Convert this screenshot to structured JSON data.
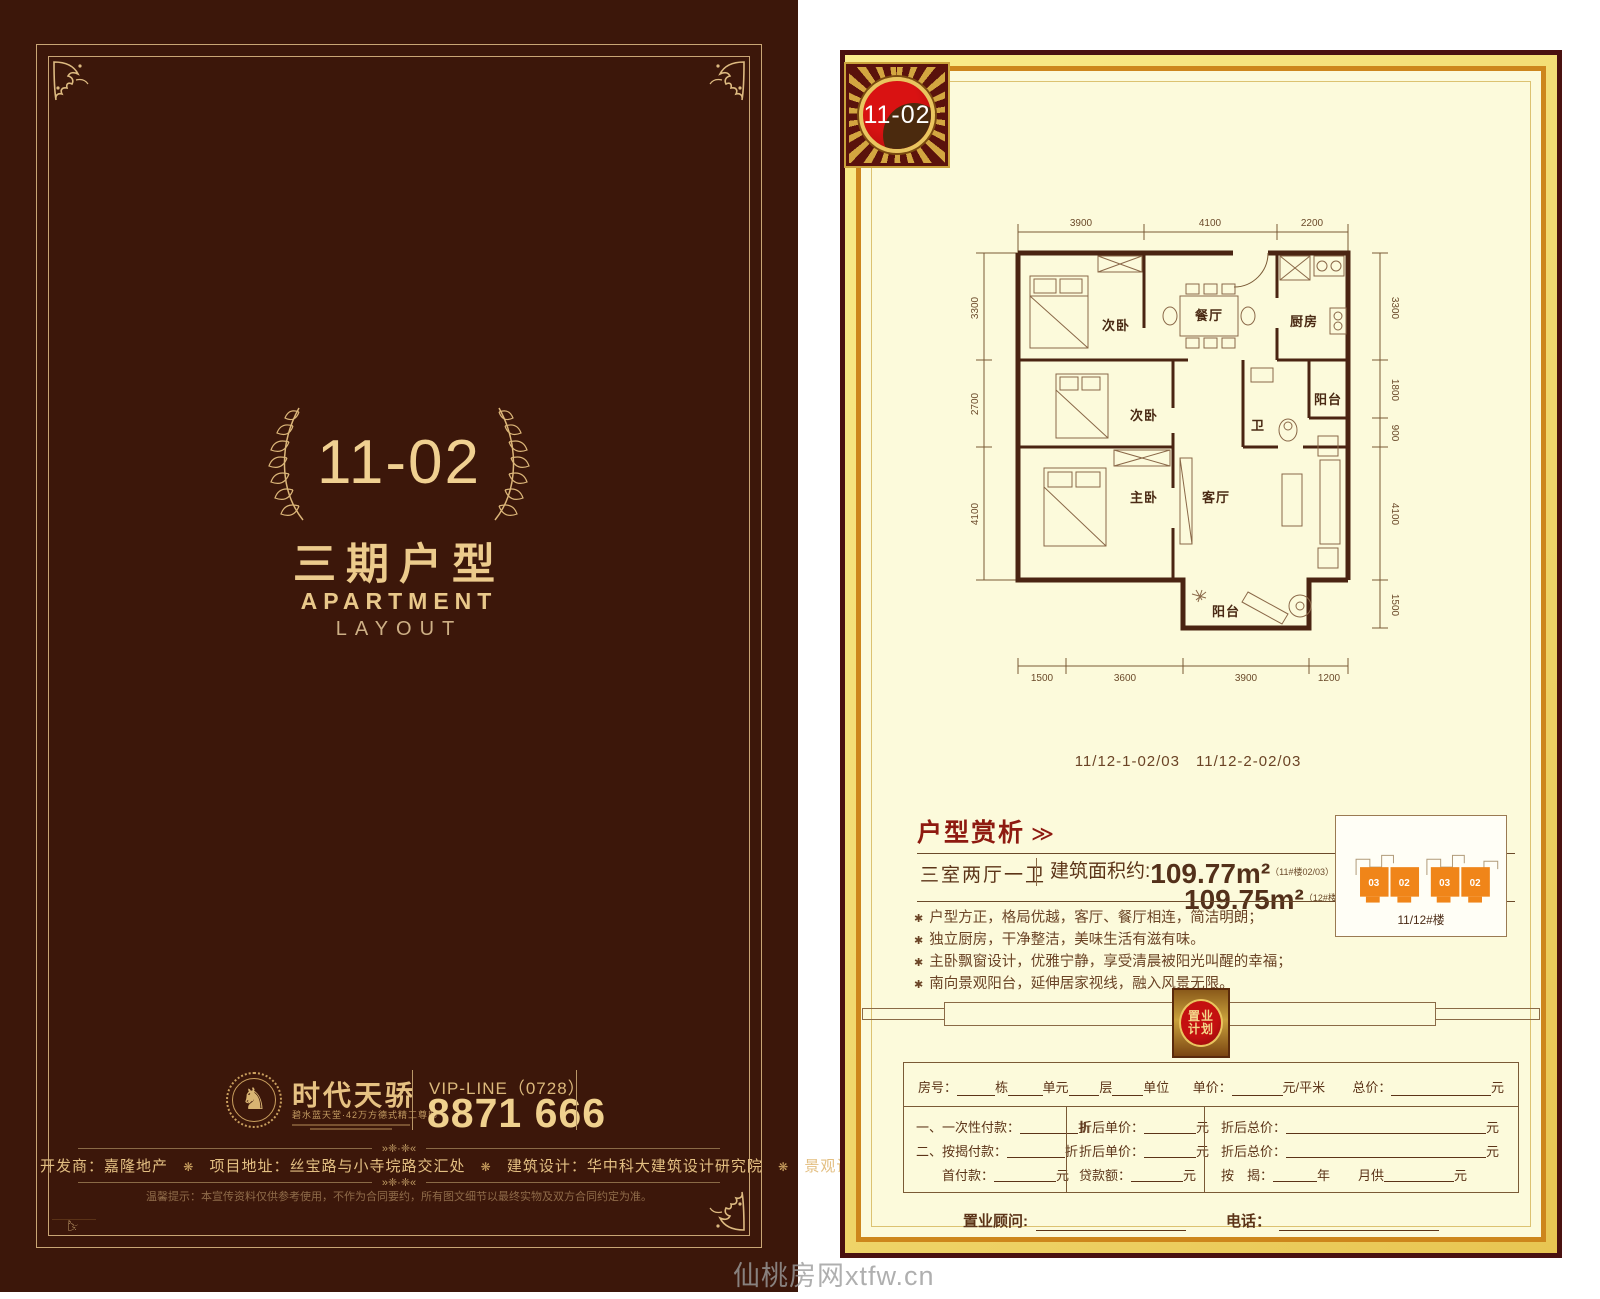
{
  "watermark": "仙桃房网xtfw.cn",
  "left": {
    "unit_number": "11-02",
    "series_title": "三期户型",
    "en_title_1": "APARTMENT",
    "en_title_2": "LAYOUT",
    "brand_name": "时代天骄",
    "brand_tagline": "碧水蓝天堂·42万方德式精工尊邸",
    "vip_label": "VIP-LINE（0728）",
    "vip_number": "8871 666",
    "ornament": "»❈·❈«",
    "info_separator": "❋",
    "info": [
      {
        "label": "开发商：",
        "value": "嘉隆地产"
      },
      {
        "label": "项目地址：",
        "value": "丝宝路与小寺垸路交汇处"
      },
      {
        "label": "建筑设计：",
        "value": "华中科大建筑设计研究院"
      },
      {
        "label": "景观设计：",
        "value": "天地大美（武汉）"
      }
    ],
    "disclaimer": "温馨提示：本宣传资料仅供参考使用，不作为合同要约，所有图文细节以最终实物及双方合同约定为准。"
  },
  "right": {
    "badge": "11-02",
    "plan": {
      "caption": "11/12-1-02/03　11/12-2-02/03",
      "rooms": {
        "bed_top": "次卧",
        "dining": "餐厅",
        "kitchen": "厨房",
        "bed_mid": "次卧",
        "bath": "卫",
        "balcony_side": "阳台",
        "master": "主卧",
        "living": "客厅",
        "balcony_main": "阳台"
      },
      "dims": {
        "top": [
          "3900",
          "4100",
          "2200"
        ],
        "bottom": [
          "1500",
          "3600",
          "3900",
          "1200"
        ],
        "left": [
          "3300",
          "2700",
          "4100"
        ],
        "right": [
          "3300",
          "1800",
          "900",
          "4100",
          "1500"
        ]
      }
    },
    "analysis": {
      "title": "户型赏析",
      "arrow": "≫",
      "unit_type": "三室两厅一卫",
      "area_label": "建筑面积约:",
      "area_1": "109.77m²",
      "area_1_note": "（11#楼02/03）",
      "area_2": "109.75m²",
      "area_2_note": "（12#楼02/03）",
      "bullet_marker": "✱",
      "bullets": [
        "户型方正，格局优越，客厅、餐厅相连，简洁明朗；",
        "独立厨房，干净整洁，美味生活有滋有味。",
        "主卧飘窗设计，优雅宁静，享受清晨被阳光叫醒的幸福；",
        "南向景观阳台，延伸居家视线，融入风景无限。"
      ]
    },
    "diagram": {
      "caption": "11/12#楼",
      "units": [
        "03",
        "02",
        "03",
        "02"
      ]
    },
    "plan_badge_line1": "置业",
    "plan_badge_line2": "计划",
    "form": {
      "room_label": "房号：",
      "room_u1": "栋",
      "room_u2": "单元",
      "room_u3": "层",
      "room_u4": "单位",
      "price_label": "单价：",
      "price_unit": "元/平米",
      "total_label": "总价：",
      "total_unit": "元",
      "r1c1_label": "一、一次性付款：",
      "r1c1_unit": "折",
      "r1c2_label": "折后单价：",
      "r1c2_unit": "元",
      "r1c3_label": "折后总价：",
      "r1c3_unit": "元",
      "r2c1_label": "二、按揭付款：",
      "r2c1_unit": "折",
      "r2c2_label": "折后单价：",
      "r2c2_unit": "元",
      "r2c3_label": "折后总价：",
      "r2c3_unit": "元",
      "r3c1_label": "首付款：",
      "r3c1_unit": "元",
      "r3c2_label": "贷款额：",
      "r3c2_unit": "元",
      "r3c3_label": "按　揭：",
      "r3c3_mid": "年",
      "r3c3_label2": "月供",
      "r3c3_unit": "元",
      "consultant_label": "置业顾问:",
      "phone_label": "电话："
    }
  }
}
